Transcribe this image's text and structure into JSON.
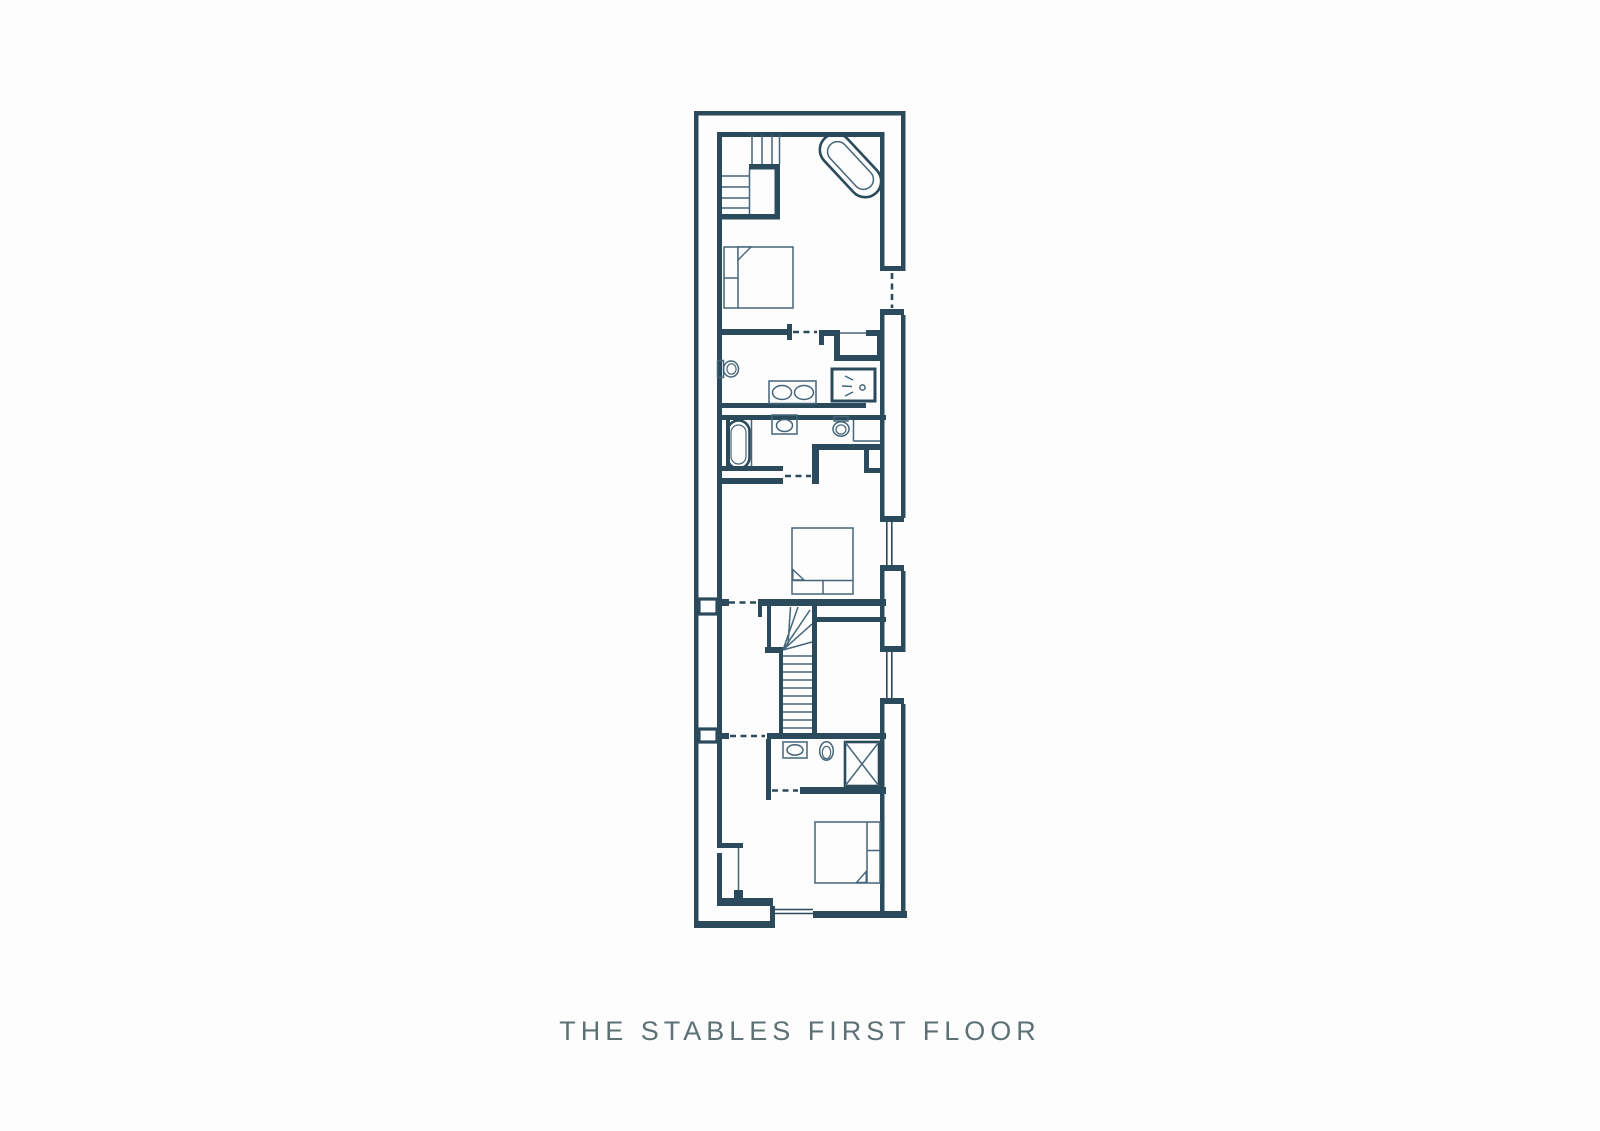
{
  "caption": {
    "title": "THE STABLES FIRST FLOOR"
  },
  "colors": {
    "wall": "#2b4a5b",
    "fixture": "#44657a",
    "text": "#5d7174",
    "background": "#fdfdfd"
  },
  "plan": {
    "type": "floor-plan",
    "fixtures": [
      {
        "icon": "staircase-icon",
        "area": "top-left-bedroom"
      },
      {
        "icon": "bathtub-icon",
        "area": "top-right-corner"
      },
      {
        "icon": "double-bed-icon",
        "area": "top-bedroom"
      },
      {
        "icon": "toilet-icon",
        "area": "first-bathroom"
      },
      {
        "icon": "double-basin-icon",
        "area": "first-bathroom"
      },
      {
        "icon": "shower-icon",
        "area": "first-bathroom"
      },
      {
        "icon": "bathtub-icon",
        "area": "second-bathroom"
      },
      {
        "icon": "basin-icon",
        "area": "second-bathroom"
      },
      {
        "icon": "toilet-icon",
        "area": "second-bathroom"
      },
      {
        "icon": "double-bed-icon",
        "area": "middle-bedroom"
      },
      {
        "icon": "staircase-icon",
        "area": "central-stairwell"
      },
      {
        "icon": "basin-icon",
        "area": "third-bathroom"
      },
      {
        "icon": "toilet-icon",
        "area": "third-bathroom"
      },
      {
        "icon": "shower-cubicle-icon",
        "area": "third-bathroom"
      },
      {
        "icon": "double-bed-icon",
        "area": "bottom-bedroom"
      },
      {
        "icon": "wardrobe-icon",
        "area": "bottom-bedroom"
      }
    ],
    "doorway_openings": 6,
    "windows": 2
  }
}
